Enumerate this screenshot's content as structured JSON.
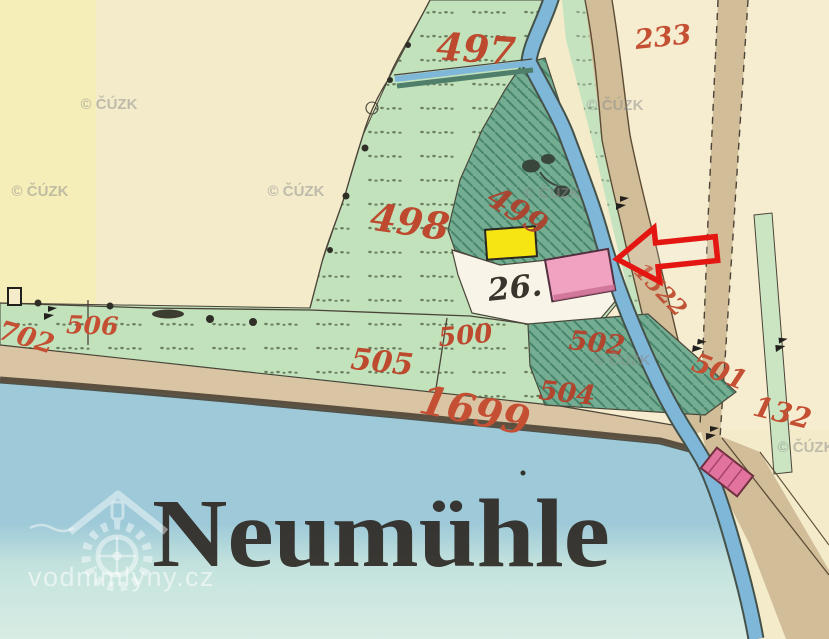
{
  "map": {
    "title": "Historic cadastral map detail",
    "place_label": "Neumühle",
    "labels": [
      {
        "text": "497",
        "x": 475,
        "y": 62,
        "size": 38,
        "rot": 4,
        "color": "#bd4a2e"
      },
      {
        "text": "233",
        "x": 664,
        "y": 46,
        "size": 27,
        "rot": -6,
        "color": "#c44f33"
      },
      {
        "text": "498",
        "x": 408,
        "y": 235,
        "size": 38,
        "rot": 8,
        "color": "#bd4a2e"
      },
      {
        "text": "499",
        "x": 512,
        "y": 220,
        "size": 31,
        "rot": 32,
        "color": "#a84631"
      },
      {
        "text": "500",
        "x": 466,
        "y": 344,
        "size": 26,
        "rot": -5,
        "color": "#bd4a2e"
      },
      {
        "text": "501",
        "x": 716,
        "y": 380,
        "size": 27,
        "rot": 22,
        "color": "#c44f33"
      },
      {
        "text": "502",
        "x": 596,
        "y": 352,
        "size": 27,
        "rot": 6,
        "color": "#b1452e"
      },
      {
        "text": "504",
        "x": 566,
        "y": 402,
        "size": 27,
        "rot": 6,
        "color": "#b1452e"
      },
      {
        "text": "505",
        "x": 381,
        "y": 372,
        "size": 30,
        "rot": 6,
        "color": "#bd4a2e"
      },
      {
        "text": "506",
        "x": 92,
        "y": 334,
        "size": 25,
        "rot": 2,
        "color": "#c44f33"
      },
      {
        "text": "702",
        "x": 24,
        "y": 346,
        "size": 27,
        "rot": 16,
        "color": "#c44f33"
      },
      {
        "text": "1699",
        "x": 472,
        "y": 424,
        "size": 40,
        "rot": 12,
        "color": "#c44f33"
      },
      {
        "text": "1522",
        "x": 655,
        "y": 295,
        "size": 23,
        "rot": 46,
        "color": "#c05438"
      },
      {
        "text": "132",
        "x": 780,
        "y": 422,
        "size": 28,
        "rot": 14,
        "color": "#c44f33"
      },
      {
        "text": "26.",
        "x": 516,
        "y": 298,
        "size": 31,
        "rot": -6,
        "color": "#3a342c"
      }
    ],
    "watermarks": {
      "cuzk_text": "© ČÚZK",
      "cuzk_positions": [
        [
          109,
          109
        ],
        [
          615,
          110
        ],
        [
          40,
          196
        ],
        [
          296,
          196
        ],
        [
          552,
          198
        ],
        [
          622,
          365
        ],
        [
          806,
          452
        ]
      ],
      "site_text": "vodnimlyny.cz"
    },
    "annotation": {
      "arrow_meaning": "red arrow pointing at pink building (parcel 26)"
    },
    "colors": {
      "paper_cream": "#f3ebca",
      "paper_yellow": "#f8f0a9",
      "meadow_green": "#c2e2bb",
      "garden_dark_green": "#74ad91",
      "hatch_green": "#3c7a62",
      "stream_blue": "#7fb7d8",
      "pond_blue_top": "#9dc9d8",
      "pond_pale": "#d8ede4",
      "road_tan": "#d2bd99",
      "shore_tan": "#d9c4a3",
      "building_yellow": "#f6e413",
      "building_pink": "#f0a2c0",
      "bridge_pink": "#e2739f",
      "label_red": "#c44f33",
      "arrow_red": "#e41612",
      "ink": "#4a4438"
    }
  }
}
